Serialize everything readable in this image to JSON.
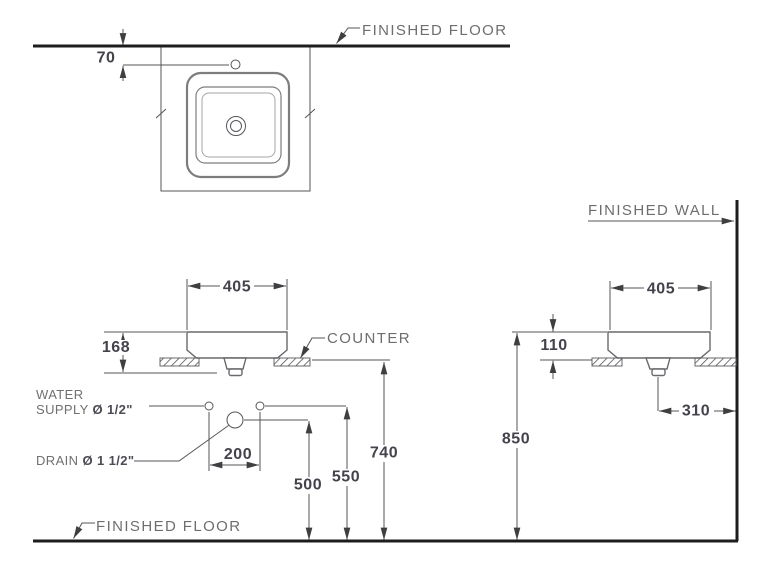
{
  "drawing": {
    "title": "countertop basin installation drawing",
    "views": [
      "plan",
      "front-elevation",
      "side-elevation"
    ]
  },
  "labels": {
    "finished_floor_top": "FINISHED FLOOR",
    "finished_floor_bottom": "FINISHED FLOOR",
    "finished_wall": "FINISHED WALL",
    "counter": "COUNTER",
    "water_line1": "WATER",
    "supply_prefix": "SUPPLY ",
    "supply_size": "Ø 1/2\"",
    "drain_prefix": "DRAIN ",
    "drain_size": "Ø 1 1/2\""
  },
  "dimensions": {
    "faucet_hole_offset": "70",
    "basin_width_front": "405",
    "basin_rim_depth_front": "168",
    "supply_spacing": "200",
    "drain_height": "500",
    "supply_height": "550",
    "counter_height": "740",
    "basin_width_side": "405",
    "basin_height_above_counter": "110",
    "rim_height_from_floor": "850",
    "drain_offset_from_wall": "310"
  },
  "colors": {
    "line_thick": "#1d1d1f",
    "line_thin": "#55555a",
    "dimension_text": "#43434c",
    "label_text": "#6e6e6e",
    "background": "#ffffff"
  }
}
